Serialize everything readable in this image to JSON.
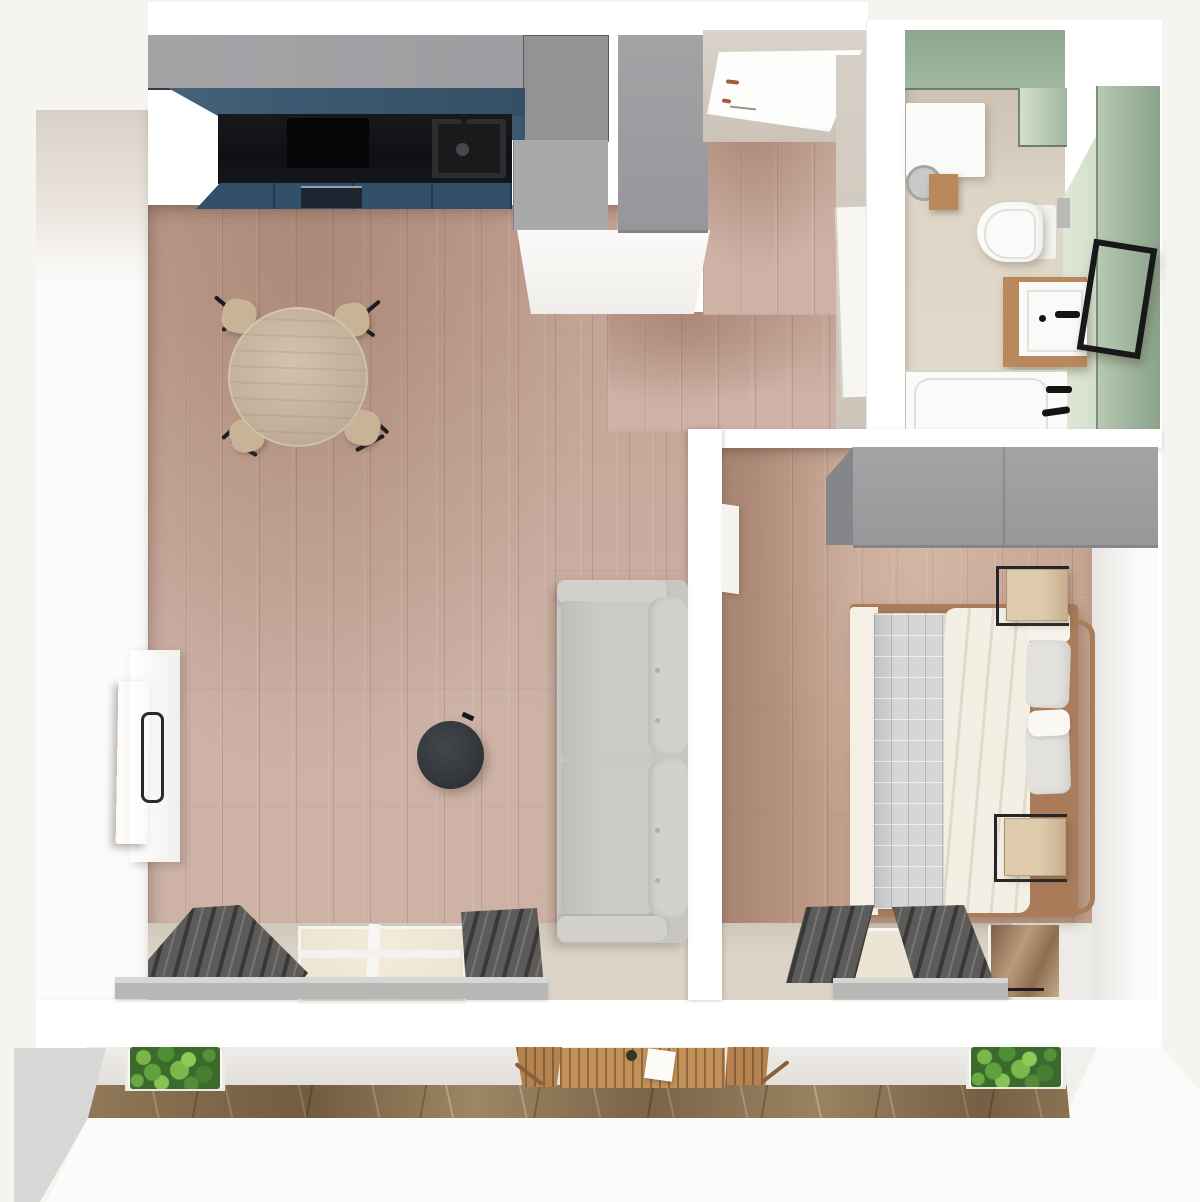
{
  "meta": {
    "title": "Top-down 3D render of a one-bedroom apartment floor plan",
    "view": "bird's-eye 3D floor plan, no visible text"
  },
  "palette": {
    "bg": "#f6f4f0",
    "wall": "#ffffff",
    "plaster": "#d8d1c7",
    "floor-wood": "#c7a99b",
    "floor-bedroom": "#c4a28f",
    "floor-strip": "#dad3c6",
    "cab-gray": "#9c9ca0",
    "cab-gray-light": "#a9a9ac",
    "cab-blue": "#3c5871",
    "cab-blue-dark": "#32506a",
    "counter-black": "#121417",
    "green-wall": "#9fb6a1",
    "green-wall-light": "#d3dfcd",
    "green-wall-dark": "#8aa28a",
    "bath-floor": "#ddd5c6",
    "bath-wall": "#ccc3b4",
    "fixture-white": "#fafaf8",
    "wood-warm": "#b9895c",
    "wood-light": "#ddcbab",
    "bed-frame": "#aa7c5a",
    "quilt": "#d5d6d8",
    "duvet": "#f3efe4",
    "pillow": "#e2e1dd",
    "sofa": "#c7c6c3",
    "sofa-light": "#d2d1ce",
    "table-dark": "#35383c",
    "curtain": "#5d5b59",
    "sill": "#b8b9b7",
    "glass": "#ece5d4",
    "tile": "#bfae94",
    "plant-light": "#7ab648",
    "wood-balcony": "#b5834f",
    "chair-wood": "#c9b397",
    "door-white": "#fdfdfc",
    "handle-brown": "#a15c3e"
  },
  "rooms": [
    {
      "id": "living-kitchen",
      "label": "open-plan living room and kitchen",
      "furniture": [
        "kitchen upper cabinets",
        "blue cabinet fronts",
        "black countertop",
        "cooktop",
        "sink with faucet",
        "oven",
        "tall cabinet column",
        "round dining table",
        "4 dining chairs",
        "tv sideboard",
        "tv",
        "sofa",
        "round coffee table",
        "window with curtains"
      ]
    },
    {
      "id": "hallway",
      "label": "entrance hallway",
      "furniture": [
        "entrance door",
        "hall wardrobe",
        "bathroom door"
      ]
    },
    {
      "id": "bathroom",
      "label": "bathroom with sage-green walls",
      "furniture": [
        "washing machine",
        "wall-hung toilet",
        "flush plate",
        "vanity with basin",
        "black-framed mirror",
        "bathtub with black fittings"
      ]
    },
    {
      "id": "bedroom",
      "label": "bedroom",
      "furniture": [
        "gray wardrobe",
        "double bed with white duvet and gray quilt",
        "pillows",
        "2 wooden nightstands with black frames",
        "window with curtains",
        "open door panel"
      ]
    },
    {
      "id": "balcony",
      "label": "balcony terrace",
      "furniture": [
        "left planter box",
        "wooden bistro table",
        "2 wooden chairs",
        "right planter box",
        "stone tile floor"
      ]
    }
  ]
}
